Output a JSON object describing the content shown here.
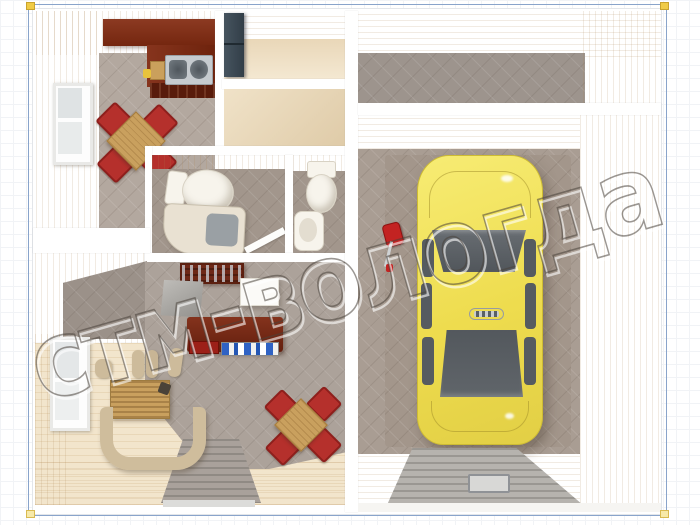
{
  "watermark": {
    "text": "стм-вологда",
    "style": "embossed-outline",
    "rotation_deg": -16
  },
  "canvas": {
    "background": "#ffffff",
    "grid_color": "#f1f3f6"
  },
  "selection_frame": {
    "border_color": "#89a4cb",
    "handle_color": "#f0cb45",
    "corners": 4
  },
  "floor_plan": {
    "view": "top-down-3d-render",
    "palette": {
      "wall_face": "#eeddc1",
      "wall_cut": "#ffffff",
      "wood_floor": "#f2e5cc",
      "tile_floor": "#aba199",
      "kitchen_cabinet": "#7c2b18",
      "accent_chair": "#b5302c",
      "sofa": "#cfbd9c",
      "wardrobe": "#3d4b58",
      "desk": "#70271a",
      "car_body": "#eedc4e",
      "car_glass": "#5c6166",
      "ramp": "#b6b3ae",
      "jack": "#c32322"
    },
    "rooms": [
      {
        "name": "kitchen-dining"
      },
      {
        "name": "entrance-hall"
      },
      {
        "name": "corridor"
      },
      {
        "name": "bathroom"
      },
      {
        "name": "wc"
      },
      {
        "name": "storage"
      },
      {
        "name": "study-living-room"
      },
      {
        "name": "workshop"
      },
      {
        "name": "garage"
      }
    ],
    "objects": [
      "kitchen-counter",
      "double-sink",
      "cutting-board",
      "dining-table",
      "red-chairs",
      "window",
      "wardrobe",
      "toilet",
      "shower-vanity",
      "wash-basin",
      "tool-rack",
      "white-cabinet",
      "desk",
      "computer-items",
      "sofa-set",
      "wicker-table",
      "yellow-car",
      "hydraulic-jack",
      "garage-ramp",
      "floor-hatch",
      "entry-walkway"
    ]
  }
}
